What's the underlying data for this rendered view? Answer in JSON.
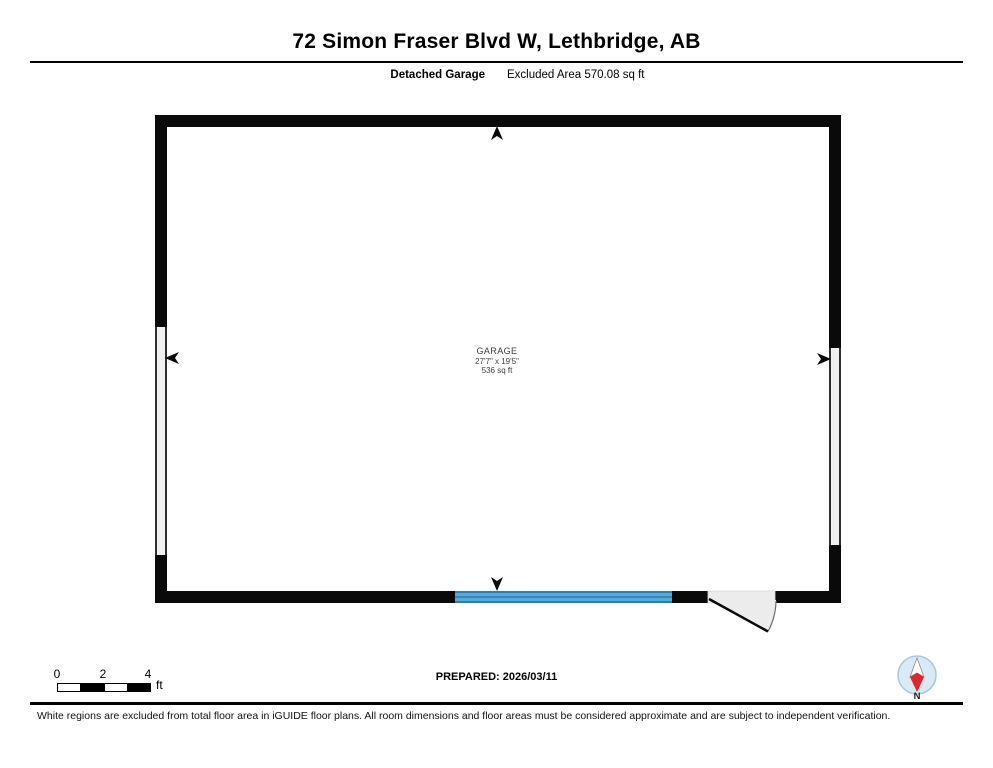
{
  "header": {
    "title": "72 Simon Fraser Blvd W, Lethbridge, AB",
    "floor_label": "Detached Garage",
    "excluded_area_label": "Excluded Area 570.08 sq ft"
  },
  "plan": {
    "room": {
      "name": "GARAGE",
      "dimensions": "27'7\" x 19'5\"",
      "area": "536 sq ft"
    },
    "colors": {
      "wall": "#0a0a0a",
      "garage_door_fill": "#56abdd",
      "garage_door_line": "#2e7cb0",
      "excluded_wall_fill": "#f0f0f0",
      "door_swing_fill": "#ececec"
    }
  },
  "scale_bar": {
    "labels": [
      "0",
      "2",
      "4"
    ],
    "unit": "ft"
  },
  "footer": {
    "prepared_label": "PREPARED: 2026/03/11",
    "disclaimer": "White regions are excluded from total floor area in iGUIDE floor plans. All room dimensions and floor areas must be considered approximate and are subject to independent verification.",
    "compass_label": "N",
    "compass_needle_color": "#e3242b"
  }
}
